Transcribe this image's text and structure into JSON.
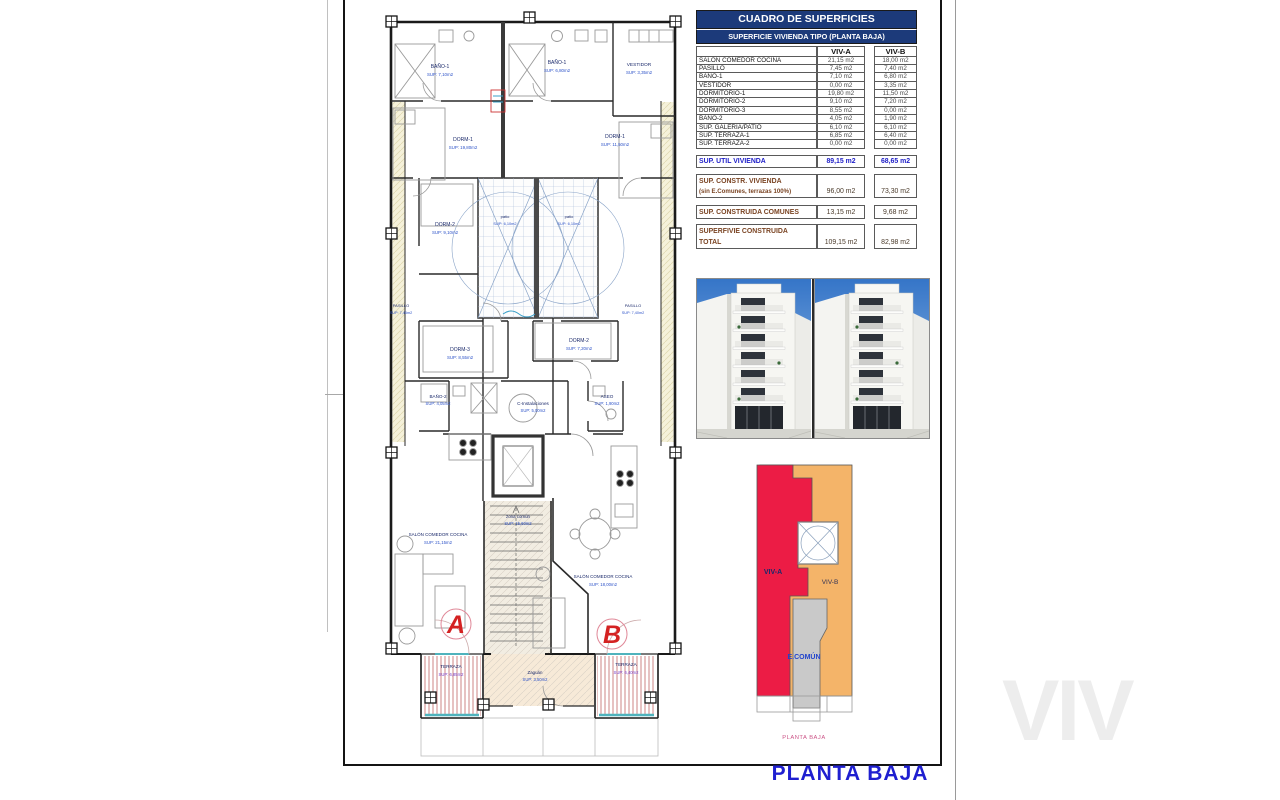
{
  "sheet": {
    "title": "PLANTA BAJA",
    "watermark": "VIV"
  },
  "surfaces_table": {
    "title": "CUADRO DE SUPERFICIES",
    "subtitle": "SUPERFICIE VIVIENDA TIPO  (PLANTA BAJA)",
    "columns": {
      "a": "VIV-A",
      "b": "VIV-B"
    },
    "rows": [
      {
        "label": "SALON COMEDOR COCINA",
        "a": "21,15 m2",
        "b": "18,00 m2"
      },
      {
        "label": "PASILLO",
        "a": "7,45 m2",
        "b": "7,40 m2"
      },
      {
        "label": "BAÑO-1",
        "a": "7,10 m2",
        "b": "6,80 m2"
      },
      {
        "label": "VESTIDOR",
        "a": "0,00 m2",
        "b": "3,35 m2"
      },
      {
        "label": "DORMITORIO-1",
        "a": "19,80 m2",
        "b": "11,50 m2"
      },
      {
        "label": "DORMITORIO-2",
        "a": "9,10 m2",
        "b": "7,20 m2"
      },
      {
        "label": "DORMITORIO-3",
        "a": "8,55 m2",
        "b": "0,00 m2"
      },
      {
        "label": "BAÑO-2",
        "a": "4,05 m2",
        "b": "1,90 m2"
      },
      {
        "label": "SUP. GALERIA/PATIO",
        "a": "6,10 m2",
        "b": "6,10 m2"
      },
      {
        "label": "SUP. TERRAZA-1",
        "a": "6,85 m2",
        "b": "6,40 m2"
      },
      {
        "label": "SUP. TERRAZA-2",
        "a": "0,00 m2",
        "b": "0,00 m2"
      }
    ],
    "summary": {
      "util": {
        "label": "SUP. UTIL VIVIENDA",
        "a": "89,15 m2",
        "b": "68,65 m2"
      },
      "constr": {
        "label": "SUP. CONSTR. VIVIENDA",
        "sublabel": "(sin E.Comunes, terrazas 100%)",
        "a": "96,00 m2",
        "b": "73,30 m2"
      },
      "comunes": {
        "label": "SUP. CONSTRUIDA COMUNES",
        "a": "13,15 m2",
        "b": "9,68 m2"
      },
      "total": {
        "label": "SUPERFIVIE CONSTRUIDA",
        "label2": "TOTAL",
        "a": "109,15 m2",
        "b": "82,98 m2"
      }
    }
  },
  "floor_plan": {
    "unit_a": "A",
    "unit_b": "B",
    "rooms": {
      "bano1_a": {
        "name": "BAÑO-1",
        "area": "SUP: 7,10m2"
      },
      "bano1_b": {
        "name": "BAÑO-1",
        "area": "SUP: 6,80m2"
      },
      "vestidor": {
        "name": "VESTIDOR",
        "area": "SUP: 3,35m2"
      },
      "dorm1_a": {
        "name": "DORM-1",
        "area": "SUP: 19,80m2"
      },
      "dorm1_b": {
        "name": "DORM-1",
        "area": "SUP: 11,50m2"
      },
      "dorm2_a": {
        "name": "DORM-2",
        "area": "SUP: 9,10m2"
      },
      "patio_a": {
        "name": "patio",
        "area": "SUP: 6,10m2"
      },
      "patio_b": {
        "name": "patio",
        "area": "SUP: 6,10m2"
      },
      "pasillo_a": {
        "name": "PASILLO",
        "area": "SUP: 7,45m2"
      },
      "pasillo_b": {
        "name": "PASILLO",
        "area": "SUP: 7,40m2"
      },
      "dorm3_a": {
        "name": "DORM-3",
        "area": "SUP: 8,55m2"
      },
      "dorm2_b": {
        "name": "DORM-2",
        "area": "SUP: 7,20m2"
      },
      "bano2_a": {
        "name": "BAÑO-2",
        "area": "SUP: 4,05m2"
      },
      "cinst": {
        "name": "C-Instalaciones",
        "area": "SUP: 5,00m2"
      },
      "aseo_b": {
        "name": "ASEO",
        "area": "SUP: 1,90m2"
      },
      "zona_comun": {
        "name": "zona común",
        "area": "SUP: 15,60m2"
      },
      "salon_a": {
        "name": "SALÓN COMEDOR COCINA",
        "area": "SUP: 21,15m2"
      },
      "salon_b": {
        "name": "SALÓN COMEDOR COCINA",
        "area": "SUP: 18,00m2"
      },
      "terraza_a": {
        "name": "TERRAZA",
        "area": "SUP: 6,85m2"
      },
      "terraza_b": {
        "name": "TERRAZA",
        "area": "SUP: 6,40m2"
      },
      "zaguan": {
        "name": "Zaguán",
        "area": "SUP: 3,50m2"
      }
    }
  },
  "key_plan": {
    "viv_a": "VIV-A",
    "viv_b": "VIV-B",
    "comun": "E.COMÚN",
    "caption": "PLANTA BAJA",
    "colors": {
      "viv_a": "#ec1c45",
      "viv_b": "#f4b469",
      "comun": "#c9c9c9"
    }
  }
}
